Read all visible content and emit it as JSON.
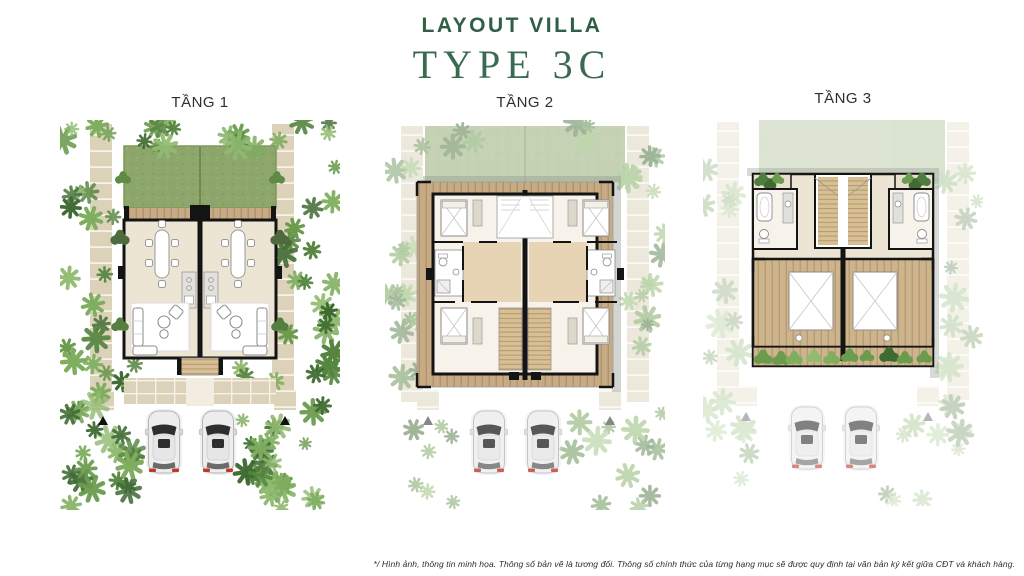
{
  "header": {
    "title": "LAYOUT VILLA",
    "subtitle": "TYPE 3C"
  },
  "floors": [
    {
      "label": "TẦNG 1"
    },
    {
      "label": "TẦNG 2"
    },
    {
      "label": "TẦNG 3"
    }
  ],
  "footer": {
    "disclaimer": "*/ Hình ảnh, thông tin minh họa. Thông số bản vẽ là tương đối. Thông số chính thức của từng hạng mục sẽ được quy định tại văn bản ký kết giữa CĐT và khách hàng."
  },
  "colors": {
    "brand_green": "#2F5F44",
    "label_dark": "#2E2E2E",
    "lawn": "#8CA66B",
    "foliage": [
      "#3F6B33",
      "#55853F",
      "#6B9B4D",
      "#7FAE5F",
      "#92BB72"
    ],
    "wood_deck": "#C6AB85",
    "floor_beige": "#EDE5D3",
    "wall_black": "#141414",
    "paver": "#DCD2BA",
    "taillight_red": "#C0392B"
  }
}
